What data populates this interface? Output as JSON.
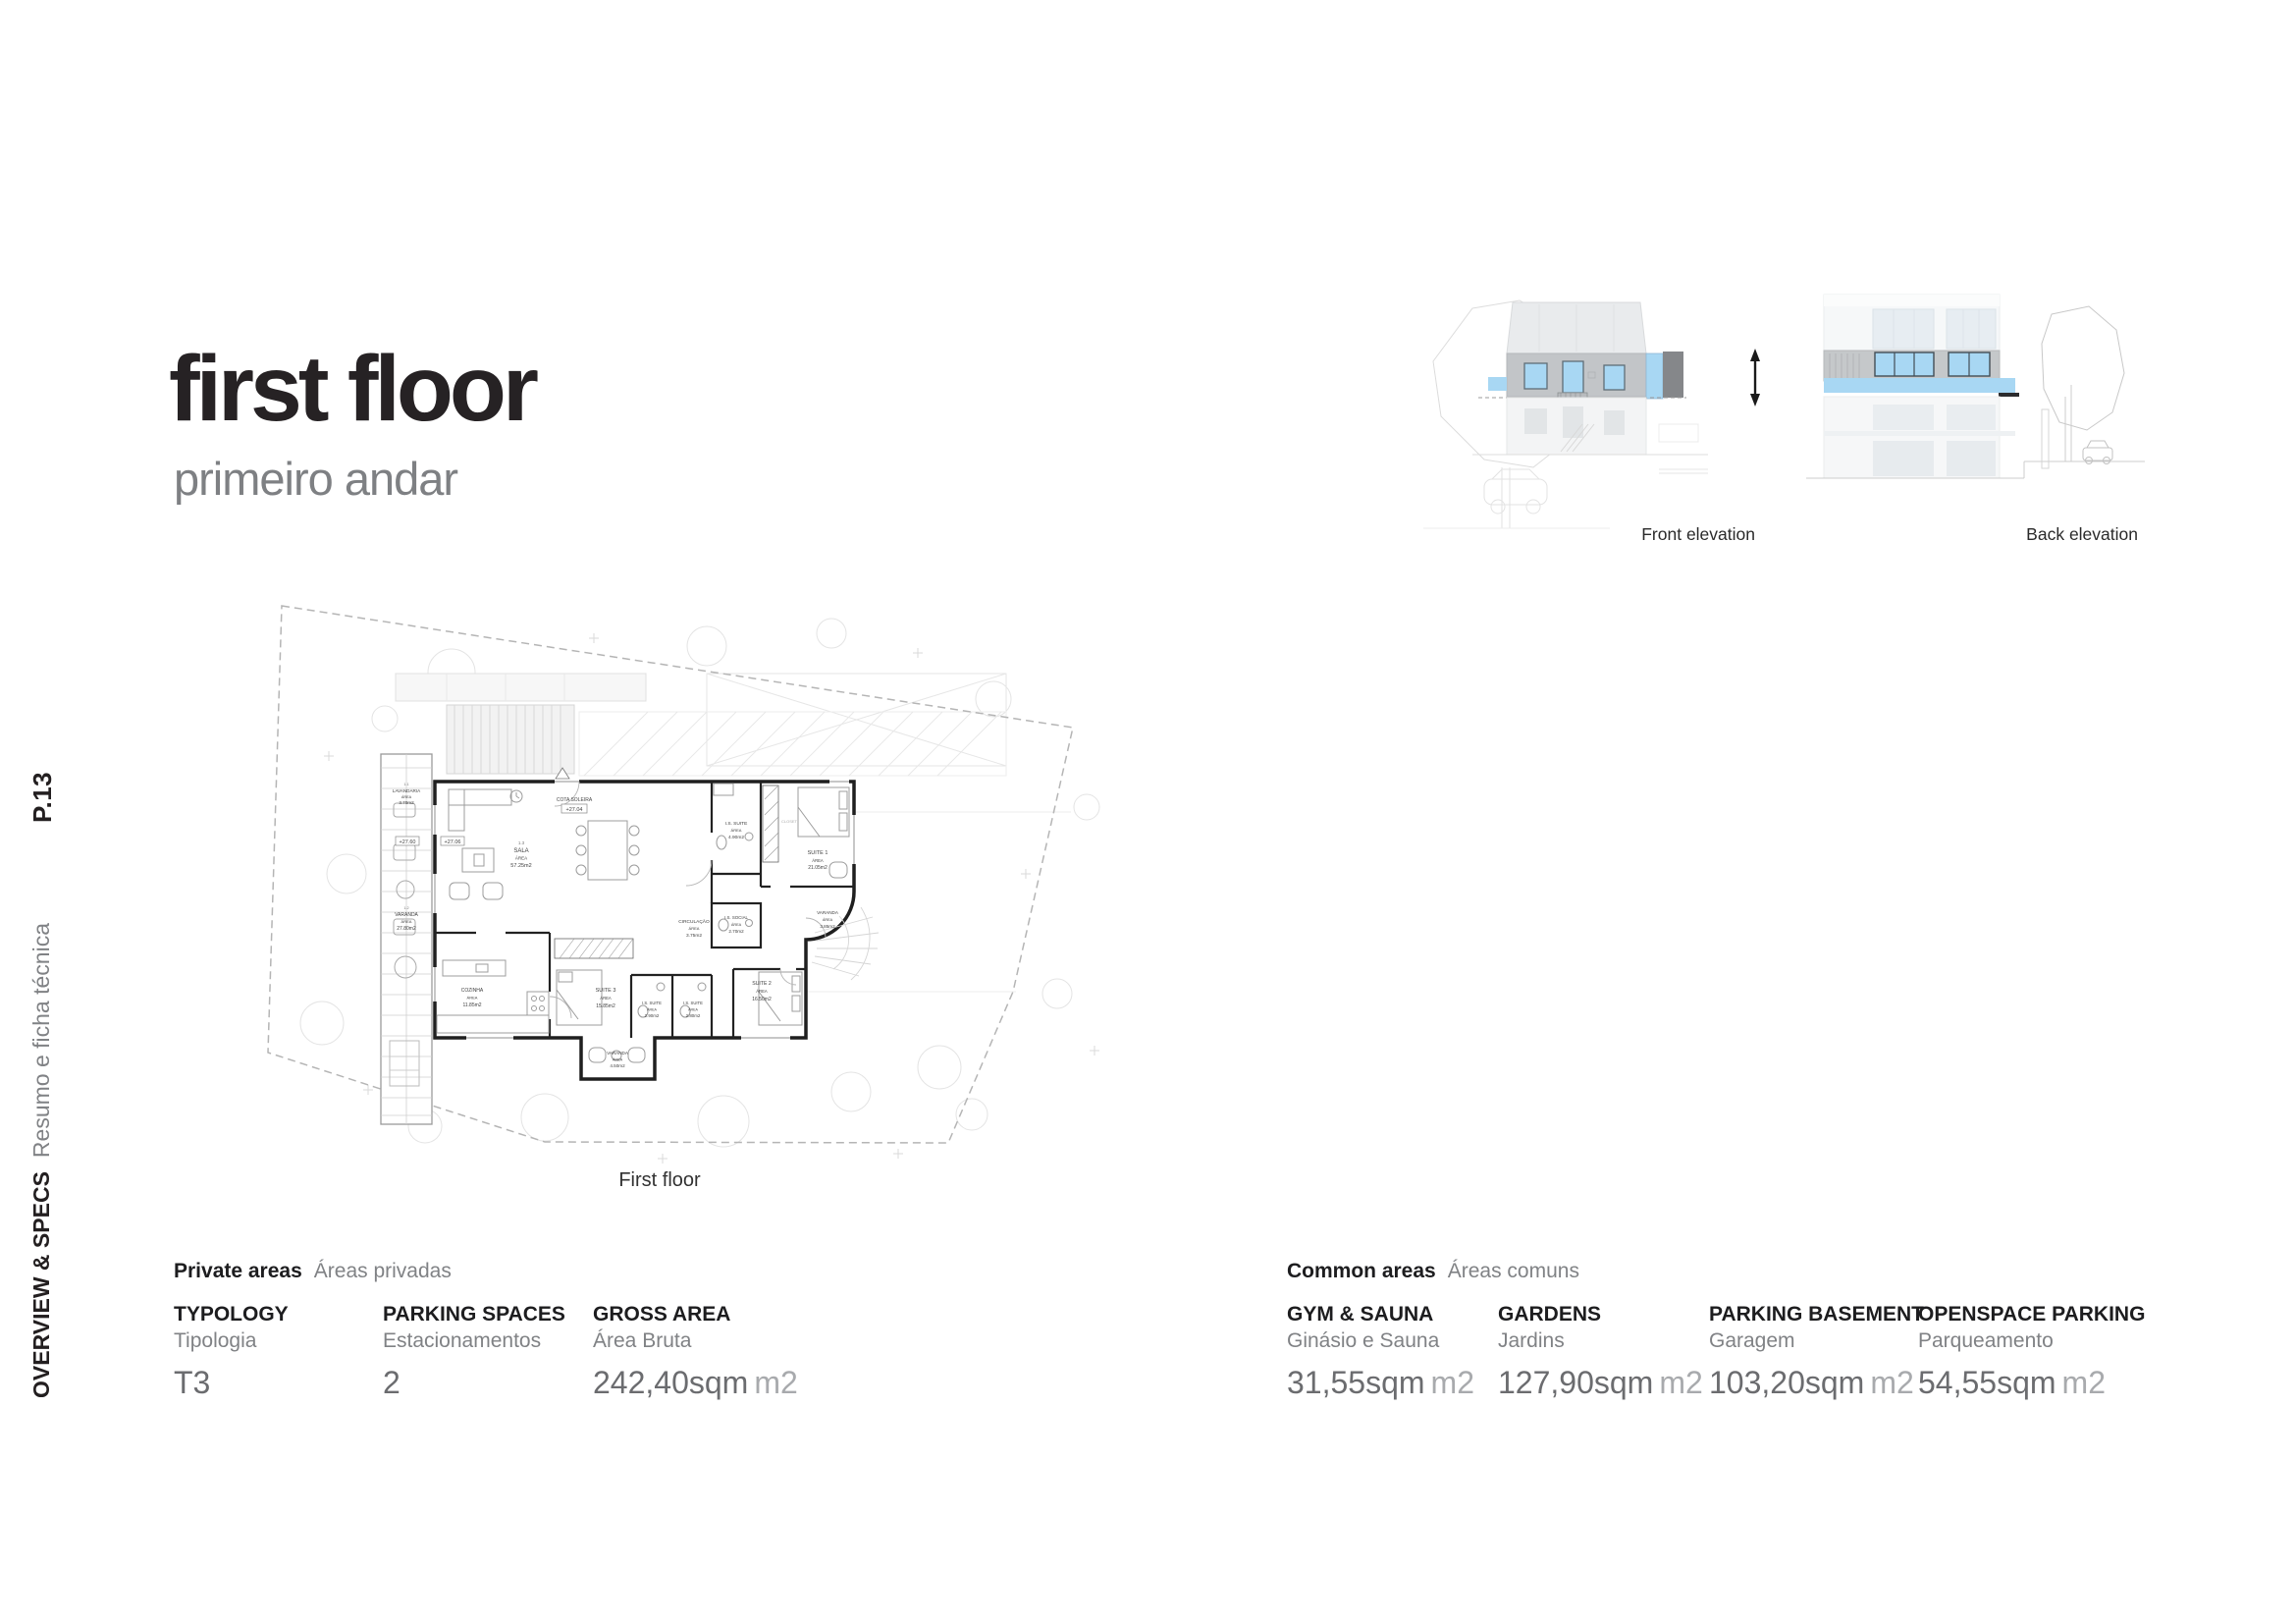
{
  "page": {
    "number_label": "P.13"
  },
  "sidebar": {
    "section": "OVERVIEW & SPECS",
    "section_sub": "Resumo e ficha técnica"
  },
  "title": {
    "main": "first floor",
    "sub": "primeiro andar"
  },
  "elevations": {
    "front_label": "Front elevation",
    "back_label": "Back elevation"
  },
  "plan": {
    "caption": "First floor",
    "area_word": "ÁREA",
    "cota_label": "COTA SOLEIRA",
    "cota_value": "+27.04",
    "level_tags": [
      "+27.60",
      "+27.06"
    ],
    "rooms": [
      {
        "code": "1.1",
        "name": "LAVANDARIA",
        "area": "3.70m2"
      },
      {
        "code": "1.2",
        "name": "VARANDA",
        "area": "27.80m2"
      },
      {
        "code": "1.3",
        "name": "SALA",
        "area": "57.25m2"
      },
      {
        "name": "I.S. SUITE",
        "area": "4.90m2"
      },
      {
        "name": "CLOSET"
      },
      {
        "name": "SUITE 1",
        "area": "21.05m2"
      },
      {
        "name": "I.S. SOCIAL",
        "area": "2.70m2"
      },
      {
        "name": "CIRCULAÇÃO",
        "area": "3.75m2"
      },
      {
        "name": "VARANDA",
        "area": "3.85m2"
      },
      {
        "name": "COZINHA",
        "area": "11.85m2"
      },
      {
        "name": "SUITE 3",
        "area": "15.85m2"
      },
      {
        "name": "I.S. SUITE",
        "area": "2.90m2"
      },
      {
        "name": "I.S. SUITE",
        "area": "2.80m2"
      },
      {
        "name": "SUITE 2",
        "area": "16.50m2"
      },
      {
        "name": "VARANDA",
        "area": "4.50m2"
      }
    ]
  },
  "specs": {
    "private": {
      "title": "Private areas",
      "subtitle": "Áreas privadas",
      "items": [
        {
          "label": "TYPOLOGY",
          "sublabel": "Tipologia",
          "value": "T3",
          "unit": ""
        },
        {
          "label": "PARKING SPACES",
          "sublabel": "Estacionamentos",
          "value": "2",
          "unit": ""
        },
        {
          "label": "GROSS AREA",
          "sublabel": "Área Bruta",
          "value": "242,40sqm",
          "unit": "m2"
        }
      ]
    },
    "common": {
      "title": "Common areas",
      "subtitle": "Áreas comuns",
      "items": [
        {
          "label": "GYM & SAUNA",
          "sublabel": "Ginásio e Sauna",
          "value": "31,55sqm",
          "unit": "m2"
        },
        {
          "label": "GARDENS",
          "sublabel": "Jardins",
          "value": "127,90sqm",
          "unit": "m2"
        },
        {
          "label": "PARKING BASEMENT",
          "sublabel": "Garagem",
          "value": "103,20sqm",
          "unit": "m2"
        },
        {
          "label": "OPENSPACE PARKING",
          "sublabel": "Parqueamento",
          "value": "54,55sqm",
          "unit": "m2"
        }
      ]
    }
  },
  "colors": {
    "accent_blue": "#a8d7f3",
    "wall_black": "#1f1f1f",
    "subtitle_gray": "#7e8083",
    "value_gray": "#6b6c6f",
    "unit_gray": "#a8aaad"
  }
}
